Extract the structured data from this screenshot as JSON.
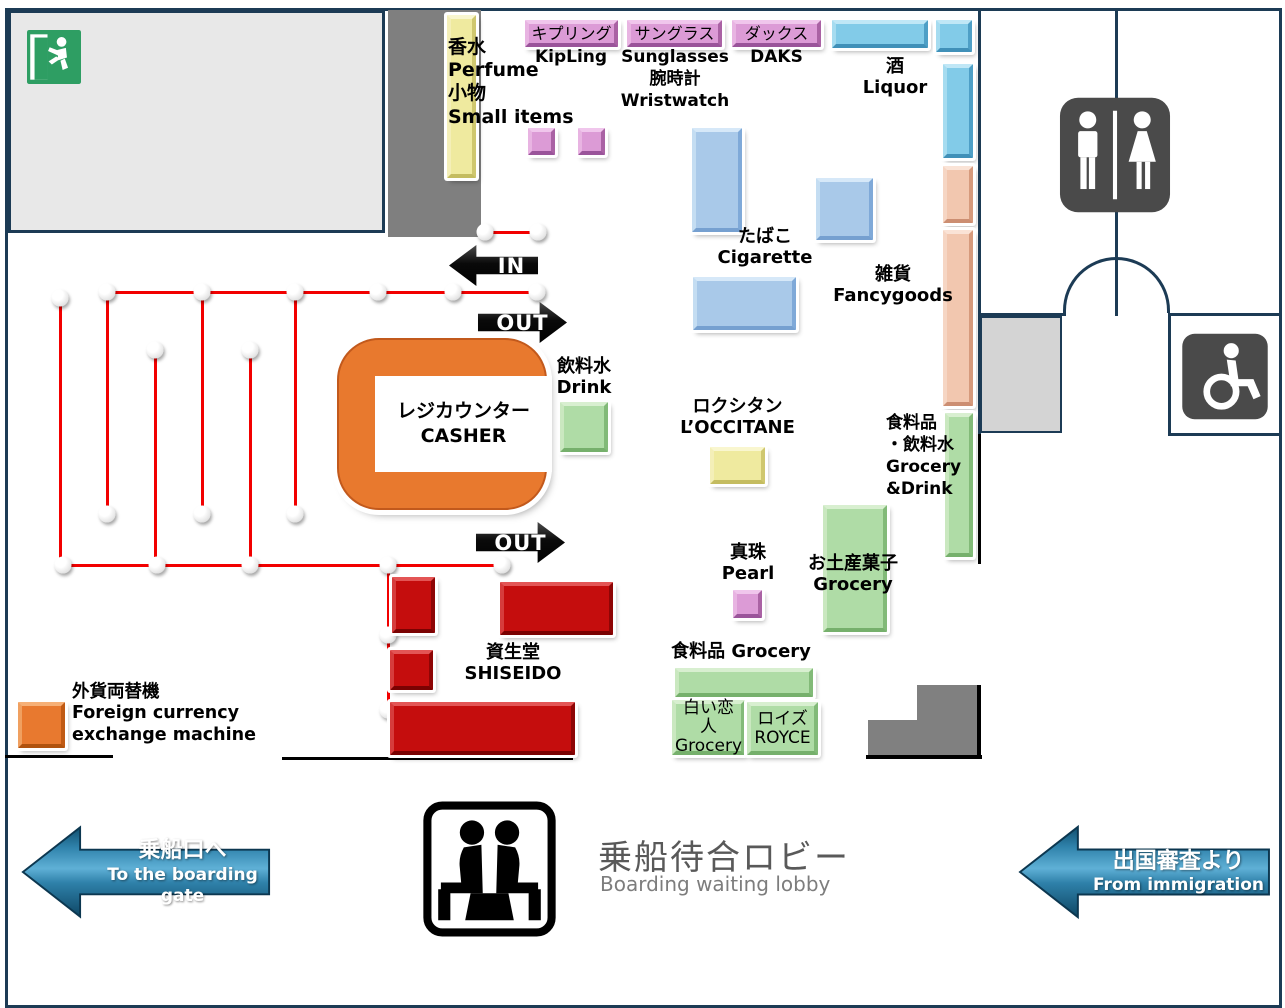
{
  "title": "Duty-free shop floor map — boarding waiting lobby",
  "shops": {
    "perfume": {
      "l1": "香水",
      "l2": "Perfume",
      "l3": "小物",
      "l4": "Small items"
    },
    "kipling": {
      "jp": "キプリング",
      "en": "KipLing"
    },
    "sunglasses": {
      "jp": "サングラス",
      "en": "Sunglasses",
      "jp2": "腕時計",
      "en2": "Wristwatch"
    },
    "daks": {
      "jp": "ダックス",
      "en": "DAKS"
    },
    "liquor": {
      "jp": "酒",
      "en": "Liquor"
    },
    "cigarette": {
      "jp": "たばこ",
      "en": "Cigarette"
    },
    "fancygoods": {
      "jp": "雑貨",
      "en": "Fancygoods"
    },
    "grocery_drink": {
      "l1": "食料品",
      "l2": "・飲料水",
      "l3": "Grocery",
      "l4": "&Drink"
    },
    "drink": {
      "jp": "飲料水",
      "en": "Drink"
    },
    "casher": {
      "jp": "レジカウンター",
      "en": "CASHER"
    },
    "loccitane": {
      "jp": "ロクシタン",
      "en": "L’OCCITANE"
    },
    "pearl": {
      "jp": "真珠",
      "en": "Pearl"
    },
    "souvenir": {
      "jp": "お土産菓子",
      "en": "Grocery"
    },
    "grocery": {
      "line": "食料品 Grocery"
    },
    "shiroi_koibito": {
      "jp": "白い恋人",
      "en": "Grocery"
    },
    "royce": {
      "jp": "ロイズ",
      "en": "ROYCE"
    },
    "shiseido": {
      "jp": "資生堂",
      "en": "SHISEIDO"
    },
    "exchange": {
      "l1": "外貨両替機",
      "l2": "Foreign currency",
      "l3": "exchange machine"
    }
  },
  "arrows": {
    "in": "IN",
    "out_upper": "OUT",
    "out_lower": "OUT"
  },
  "wayfinding": {
    "boarding": {
      "jp": "乗船口へ",
      "en": "To the boarding gate"
    },
    "immigration": {
      "jp": "出国審査より",
      "en": "From immigration"
    },
    "lobby": {
      "jp": "乗船待合ロビー",
      "en": "Boarding waiting lobby"
    }
  },
  "icons": {
    "exit": "emergency-exit",
    "restroom": "restroom-men-women",
    "wheelchair": "wheelchair-accessible",
    "lobby": "waiting-seats"
  },
  "colors": {
    "wall_navy": "#1c3b55",
    "queue_red": "#f20000",
    "casher_orange": "#e8792e",
    "exit_green": "#2e9e63",
    "sign_gray": "#4a4a4a",
    "arrow_blue": "#4fa8d2",
    "block_pink": "#dc9bd6",
    "block_skyblue": "#82cbe8",
    "block_blue": "#a9c9e9",
    "block_salmon": "#f2c7af",
    "block_green": "#afdca6",
    "block_yellow": "#efea9f",
    "block_red": "#c50d0d",
    "room_gray": "#e8e8e8",
    "column_gray": "#7f7f7f",
    "lobby_text_gray": "#595959"
  }
}
